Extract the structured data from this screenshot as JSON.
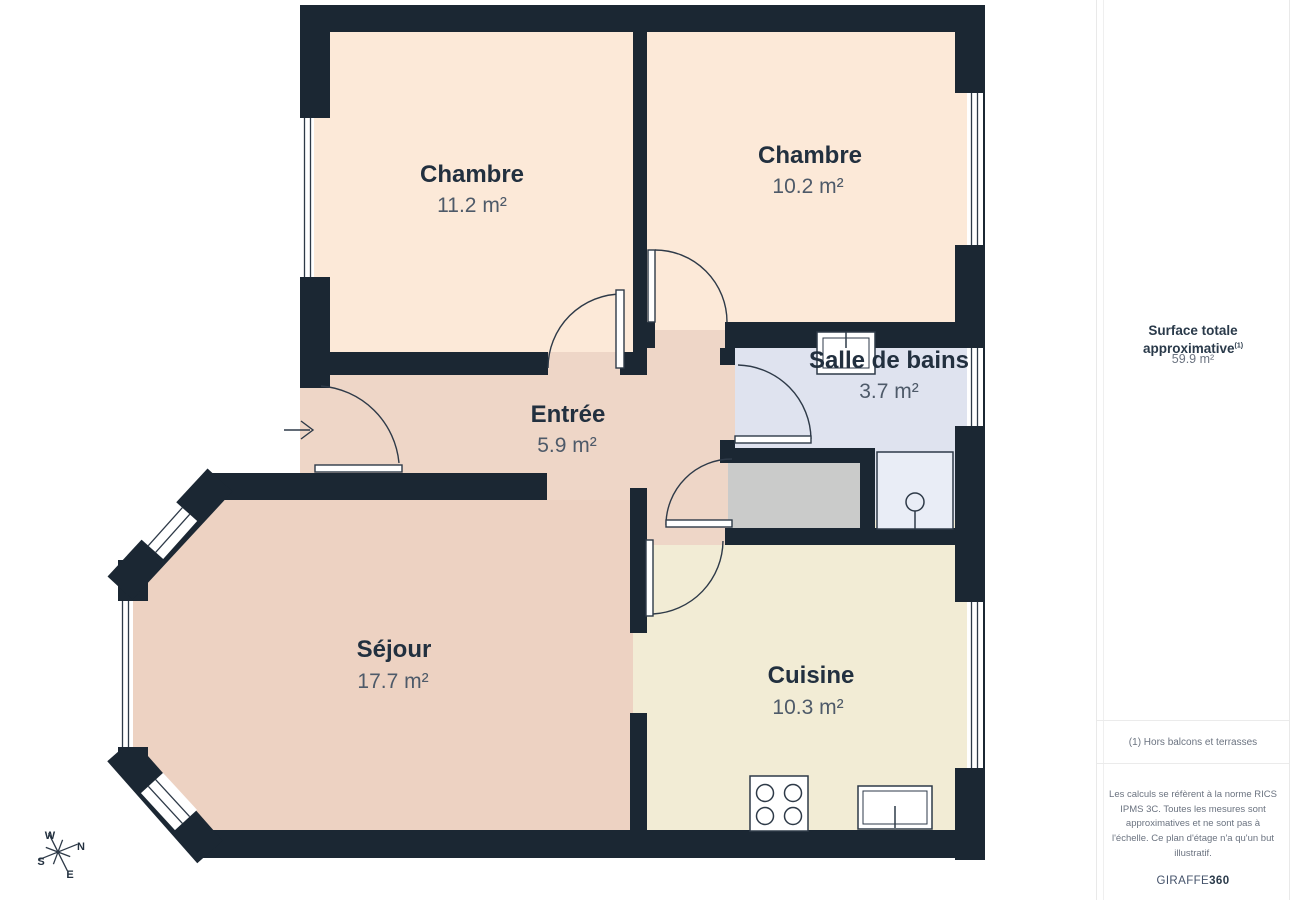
{
  "plan": {
    "rooms": [
      {
        "id": "chambre-1",
        "name": "Chambre",
        "area": "11.2 m²"
      },
      {
        "id": "chambre-2",
        "name": "Chambre",
        "area": "10.2 m²"
      },
      {
        "id": "salle-de-bains",
        "name": "Salle de bains",
        "area": "3.7 m²"
      },
      {
        "id": "entree",
        "name": "Entrée",
        "area": "5.9 m²"
      },
      {
        "id": "sejour",
        "name": "Séjour",
        "area": "17.7 m²"
      },
      {
        "id": "cuisine",
        "name": "Cuisine",
        "area": "10.3 m²"
      }
    ],
    "compass": {
      "n": "N",
      "s": "S",
      "e": "E",
      "w": "W"
    },
    "icons": [
      "entrance-arrow-icon",
      "stove-icon",
      "kitchen-sink-icon",
      "bath-sink-icon",
      "shower-icon",
      "compass-icon"
    ]
  },
  "sidebar": {
    "title": "Surface totale approximative",
    "title_superscript": "(1)",
    "total_area": "59.9 m²",
    "footnote": "(1) Hors balcons et terrasses",
    "disclaimer": "Les calculs se réfèrent à la norme RICS IPMS 3C. Toutes les mesures sont approximatives et ne sont pas à l'échelle. Ce plan d'étage n'a qu'un but illustratif.",
    "brand": {
      "name": "GIRAFFE",
      "suffix": "360"
    }
  },
  "colors": {
    "wall": "#1b2733",
    "chambre_floor": "#fce9d8",
    "entree_floor": "#eed6c7",
    "sejour_floor": "#edd2c2",
    "cuisine_floor": "#f2ecd5",
    "bath_floor": "#dfe3ef",
    "closet_floor": "#cacbca",
    "line": "#2e3a48"
  }
}
